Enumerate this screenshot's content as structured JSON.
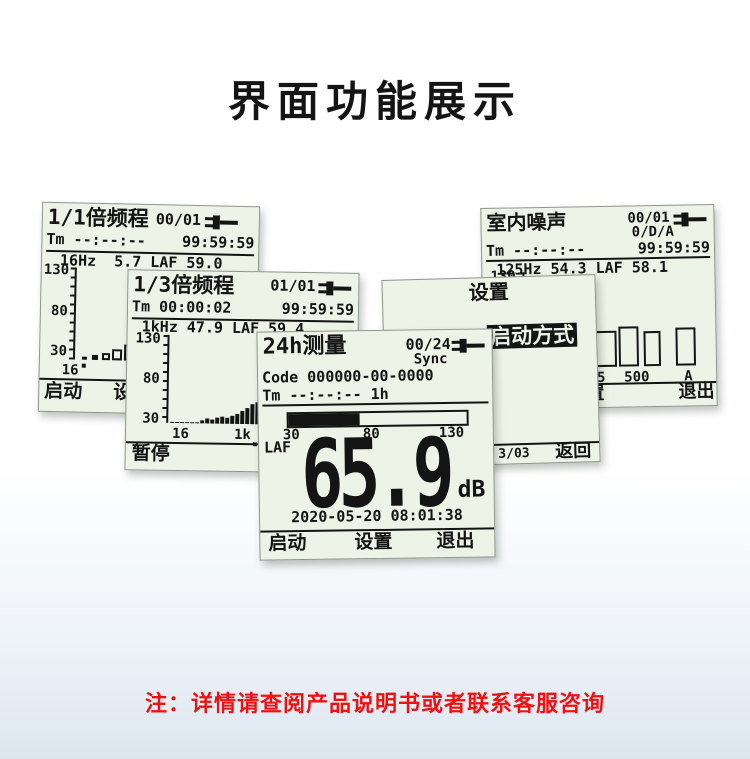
{
  "page": {
    "title": "界面功能展示",
    "note": "注：详情请查阅产品说明书或者联系客服咨询",
    "colors": {
      "note_red": "#ed1111",
      "lcd_bg": "#eef3e8",
      "lcd_ink": "#141414",
      "bg_bottom": "#dde6f0"
    }
  },
  "screens": {
    "octave11": {
      "title": "1/1倍频程",
      "counter": "00/01",
      "tm_line": "Tm --:--:--",
      "timer": "99:59:59",
      "freq_line": "16Hz  5.7 LAF 59.0",
      "y_ticks": [
        "130",
        "80",
        "30"
      ],
      "x_tick": "16",
      "bars_px": [
        {
          "x": 7,
          "w": 5,
          "h": 3,
          "solid": true
        },
        {
          "x": 17,
          "w": 6,
          "h": 5,
          "solid": true
        },
        {
          "x": 27,
          "w": 8,
          "h": 7,
          "solid": false
        },
        {
          "x": 37,
          "w": 10,
          "h": 11,
          "solid": false
        },
        {
          "x": 49,
          "w": 13,
          "h": 16,
          "solid": false
        }
      ],
      "softkeys": {
        "start": "启动",
        "setup": "设置"
      }
    },
    "octave13": {
      "title": "1/3倍频程",
      "counter": "01/01",
      "tm_line": "Tm 00:00:02",
      "timer": "99:59:59",
      "freq_line": "1kHz 47.9 LAF 59.4",
      "y_ticks": [
        "130",
        "80",
        "30"
      ],
      "x_tick_left": "16",
      "x_tick_right": "1k",
      "bar_heights_px": [
        1,
        1,
        1,
        1,
        1,
        1,
        3,
        5,
        4,
        6,
        7,
        6,
        8,
        10,
        13,
        16,
        20,
        22,
        21,
        23
      ],
      "softkeys": {
        "pause": "暂停"
      }
    },
    "measure24h": {
      "title": "24h测量",
      "counter": "00/24",
      "sync": "Sync",
      "code_line": "Code 000000-00-0000",
      "tm_line": "Tm --:--:--  1h",
      "gauge": {
        "fill_pct": 40,
        "t30": "30",
        "t80": "80",
        "t130": "130"
      },
      "weight": "LAF",
      "reading": "65.9",
      "unit": "dB",
      "datetime": "2020-05-20 08:01:38",
      "softkeys": {
        "start": "启动",
        "setup": "设置",
        "exit": "退出"
      }
    },
    "settings": {
      "title": "设置",
      "item_prefix": "5.",
      "item": "启动方式",
      "pager": "3/03",
      "back": "返回"
    },
    "indoor": {
      "title": "室内噪声",
      "counter": "00/01",
      "mode": "0/D/A",
      "tm_line": "Tm --:--:--",
      "timer": "99:59:59",
      "freq_line": "125Hz 54.3 LAF 58.1",
      "y_ticks": [
        "130",
        "80",
        "30"
      ],
      "x_tick_125": "125",
      "x_tick_500": "500",
      "x_tick_a": "A",
      "bars_px": [
        {
          "x": 68,
          "w": 23,
          "h": 36,
          "solid": false
        },
        {
          "x": 93,
          "w": 20,
          "h": 40,
          "solid": false
        },
        {
          "x": 118,
          "w": 17,
          "h": 35,
          "solid": false
        },
        {
          "x": 150,
          "w": 20,
          "h": 38,
          "solid": false
        }
      ],
      "softkeys": {
        "setup": "设置",
        "exit": "退出"
      }
    }
  },
  "chart_data": [
    {
      "type": "bar",
      "title": "1/1倍频程 spectrum",
      "ylabel": "dB",
      "ylim": [
        30,
        130
      ],
      "x_ticks_visible": [
        "16"
      ],
      "values_db_est": [
        24,
        26,
        29,
        34,
        40
      ],
      "cursor_band": "16Hz",
      "cursor_value": 5.7,
      "overall": {
        "LAF": 59.0
      }
    },
    {
      "type": "bar",
      "title": "1/3倍频程 spectrum",
      "ylabel": "dB",
      "ylim": [
        30,
        130
      ],
      "x_ticks_visible": [
        "16",
        "1k"
      ],
      "values_db_est": [
        21,
        21,
        21,
        21,
        21,
        21,
        24,
        26,
        25,
        28,
        29,
        28,
        30,
        33,
        36,
        40,
        45,
        48,
        46,
        49
      ],
      "cursor_band": "1kHz",
      "cursor_value": 47.9,
      "overall": {
        "LAF": 59.4
      }
    },
    {
      "type": "bar",
      "title": "室内噪声 band levels",
      "ylabel": "dB",
      "ylim": [
        30,
        130
      ],
      "x_ticks_visible": [
        "125",
        "500",
        "A"
      ],
      "values_db_est": [
        65,
        70,
        64,
        68
      ],
      "cursor_band": "125Hz",
      "cursor_value": 54.3,
      "overall": {
        "LAF": 58.1
      }
    },
    {
      "type": "gauge",
      "title": "24h测量 level bar",
      "range": [
        30,
        130
      ],
      "ticks": [
        "30",
        "80",
        "130"
      ],
      "value": 65.9,
      "unit": "dB",
      "weight": "LAF"
    }
  ]
}
